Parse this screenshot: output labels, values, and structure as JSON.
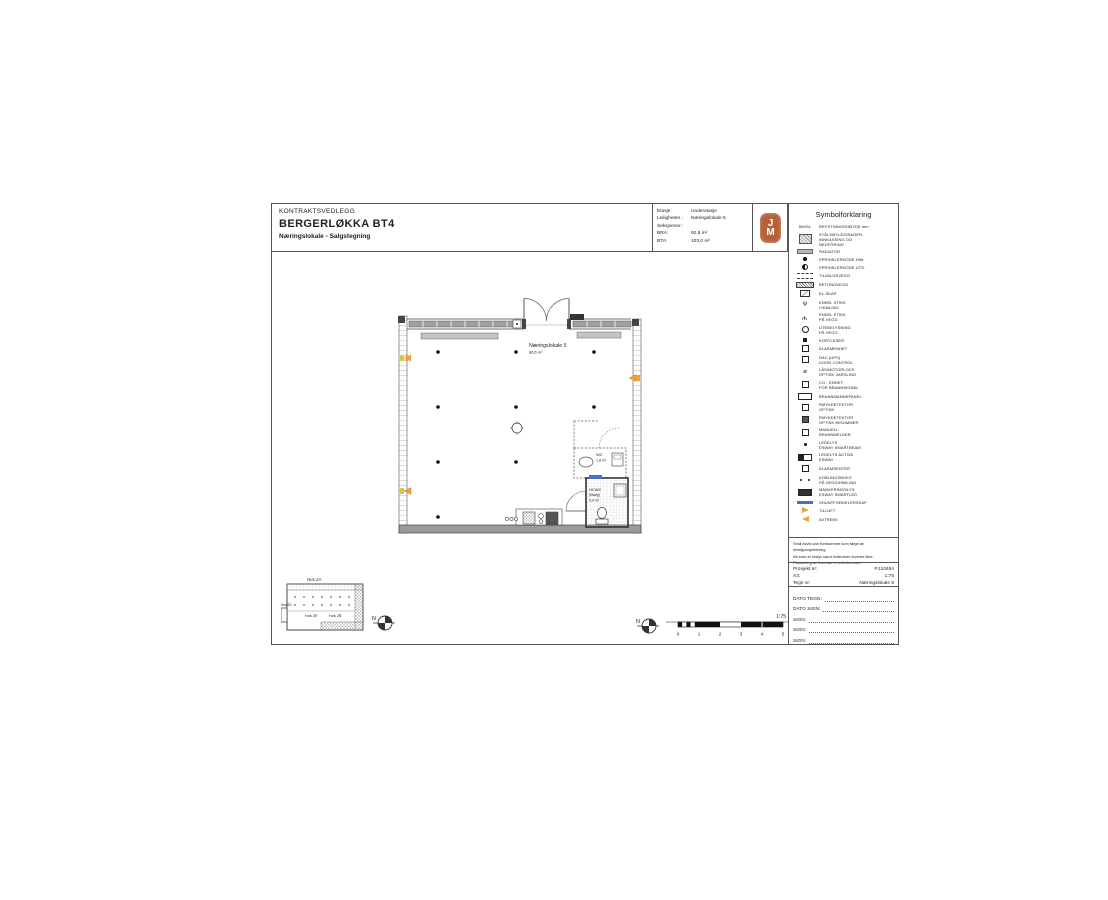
{
  "sheet": {
    "title_block": {
      "doc_type": "KONTRAKTSVEDLEGG",
      "project_title": "BERGERLØKKA BT4",
      "subtitle": "Næringslokale - Salgstegning"
    },
    "info_block": {
      "rows": [
        {
          "label": "Etasje:",
          "value": "Underetasje"
        },
        {
          "label": "Leiligheten.:",
          "value": "Næringslokale 5"
        },
        {
          "label": "Seksjonsnr.:",
          "value": ""
        },
        {
          "label": "BRA:",
          "value": "92,8 m²"
        },
        {
          "label": "BTA:",
          "value": "103,0 m²"
        }
      ]
    },
    "logo": {
      "letter_top": "J",
      "letter_bottom": "M"
    }
  },
  "legend": {
    "title": "Symbolforklaring",
    "items": [
      {
        "icon": "bh-gl-label",
        "icon_text": "BH/GL",
        "label": "BRYSTNINGSHØYDE mm"
      },
      {
        "icon": "steel-column",
        "label": "STÅLSØYLE/DRAGER,\nINNKASSING OG\nNEDFÔRING"
      },
      {
        "icon": "radiator",
        "label": "RADIATOR"
      },
      {
        "icon": "sprinkler-ceiling",
        "label": "SPRINKLERHODE HIM."
      },
      {
        "icon": "sprinkler-wall",
        "label": "SPRINKLERHODE UTS."
      },
      {
        "icon": "optional-wall",
        "label": "TILVALGSVEGG"
      },
      {
        "icon": "concrete-wall",
        "label": "BETONGVEGG"
      },
      {
        "icon": "electrical-cabinet",
        "label": "EL-SKAP"
      },
      {
        "icon": "ceiling-socket",
        "label": "ENKEL STIKK\nI HIMLING"
      },
      {
        "icon": "wall-socket",
        "label": "ENKEL STIKK\nPÅ VEGG"
      },
      {
        "icon": "outdoor-light",
        "label": "UTEBELYSNING\nPÅ VEGG"
      },
      {
        "icon": "card-reader",
        "label": "KORTLESER"
      },
      {
        "icon": "alarm-unit",
        "label": "ALARMENHET"
      },
      {
        "icon": "dac-door-control",
        "label": "DAC (UPS)\nDOOR CONTROL"
      },
      {
        "icon": "motor-lock",
        "label": "LÅS/MOTORLOCK\nOPTISK VARSLING"
      },
      {
        "icon": "co-unit",
        "label": "CO - ENHET\nFOR BRANNSIGNAL"
      },
      {
        "icon": "fire-panel",
        "label": "BRANNMANNSPANEL"
      },
      {
        "icon": "smoke-detector",
        "label": "RØYKDETEKTOR\nOPTISK"
      },
      {
        "icon": "smoke-detector-buzzer",
        "label": "RØYKDETEKTOR\nOPTISK M/SUMMER"
      },
      {
        "icon": "manual-fire-alarm",
        "label": "MANUELL\nBRANNMELDER"
      },
      {
        "icon": "emergency-light",
        "label": "LEDELYS\nESWAY SMARTBEAM"
      },
      {
        "icon": "emergency-light-activa",
        "label": "LEDELYS ACTIVA\nESWAY"
      },
      {
        "icon": "alarm-central",
        "label": "ALARMSENTER"
      },
      {
        "icon": "junction-box",
        "label": "KOBLINGSBOKS\nPÅ VEGG/HIMLING"
      },
      {
        "icon": "marker-light",
        "label": "MARKERINGSLYS\nESWAY SMARTLED"
      },
      {
        "icon": "shunt-cabinet",
        "label": "SHUNTFORDELERSKAP"
      },
      {
        "icon": "supply-air",
        "label": "TILLUFT"
      },
      {
        "icon": "extract-air",
        "label": "AVTREKK"
      }
    ]
  },
  "notes": {
    "lines": [
      "Små avvik kan forekomme som følge av detaljprosjektering.",
      "Alt som er utstyr samt hvitevarer leveres ikke.",
      "Plassering av inventar er orienterende."
    ]
  },
  "project_block": {
    "rows": [
      {
        "label": "Prosjekt nr:",
        "value": "P.110494"
      },
      {
        "label": "A3:",
        "value": "1:75"
      },
      {
        "label": "Tegn nr:",
        "value": "Næringslokale 5"
      }
    ]
  },
  "signature_block": {
    "rows": [
      "DATO TEGN:",
      "DATO SIGN:",
      "SIGN:",
      "SIGN:",
      "SIGN:"
    ]
  },
  "plan": {
    "room_name": "Næringslokale 5",
    "room_area": "86,6 m²",
    "wc_name": "WC",
    "wc_area": "1,8 m²",
    "hcwc_name": "HCWC",
    "hcwc_note": "(tilvalg)",
    "hcwc_area": "5,9 m²"
  },
  "key_plan": {
    "hus_a": "Hus 2A",
    "hus_d": "Hus 2D",
    "hus_e": "Hus 2E",
    "hus_b": "Hus 2B"
  },
  "scale_bar": {
    "ratio": "1:75",
    "ticks": [
      "0",
      "1",
      "2",
      "3",
      "4",
      "5"
    ]
  },
  "compass": {
    "letter": "N"
  },
  "colors": {
    "accent_orange": "#f0a13e",
    "accent_blue": "#4472c4",
    "logo_red": "#b5613a",
    "wall_gray": "#9b9b9b"
  }
}
